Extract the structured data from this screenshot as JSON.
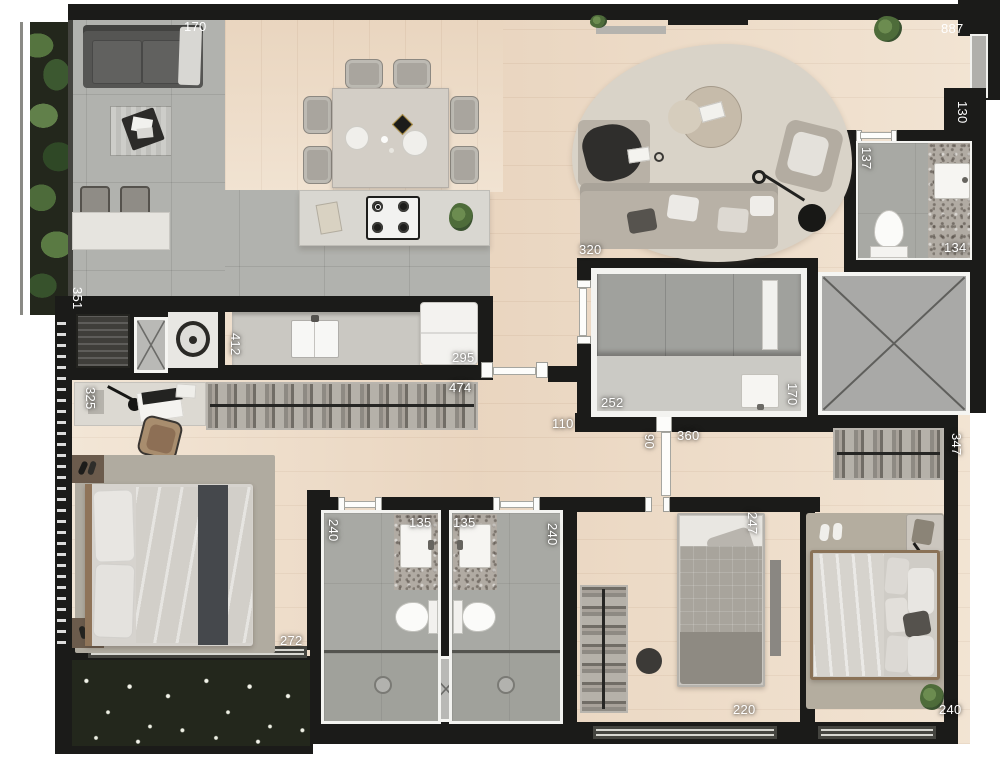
{
  "colors": {
    "wall": "#1b1b19",
    "wood_floor": "#ecdbc7",
    "gray_tile": "#b1b2ae",
    "granite": "#b1aba3",
    "elevator_fill": "#a9a9a7",
    "rug": "#d9d3c8",
    "plant_green": "#55743f",
    "dim_text": "#ffffff"
  },
  "dims": [
    {
      "text": "170"
    },
    {
      "text": "887"
    },
    {
      "text": "130"
    },
    {
      "text": "137"
    },
    {
      "text": "134"
    },
    {
      "text": "320"
    },
    {
      "text": "351"
    },
    {
      "text": "412"
    },
    {
      "text": "295"
    },
    {
      "text": "474"
    },
    {
      "text": "325"
    },
    {
      "text": "252"
    },
    {
      "text": "170"
    },
    {
      "text": "110"
    },
    {
      "text": "90"
    },
    {
      "text": "360"
    },
    {
      "text": "347"
    },
    {
      "text": "240"
    },
    {
      "text": "135"
    },
    {
      "text": "135"
    },
    {
      "text": "240"
    },
    {
      "text": "247"
    },
    {
      "text": "272"
    },
    {
      "text": "220"
    },
    {
      "text": "240"
    }
  ]
}
